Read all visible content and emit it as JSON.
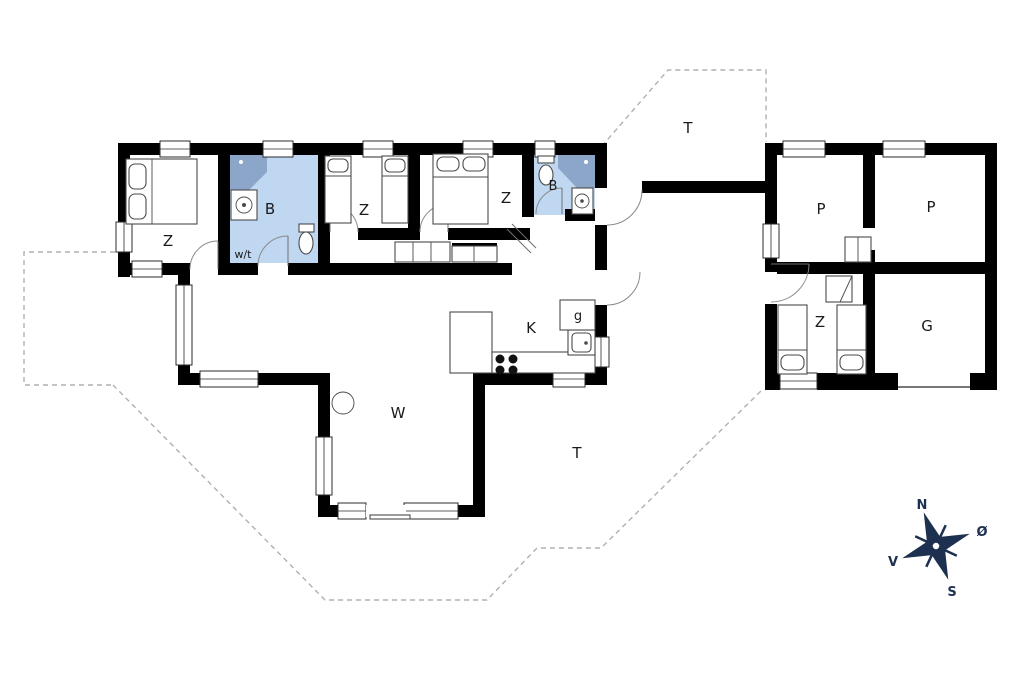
{
  "plan": {
    "type": "floor-plan",
    "colors": {
      "bath": "#bfd7f1",
      "shower": "#8ba6c9",
      "wall": "#000000",
      "dash": "#b0b0b0",
      "compass": "#1e3050"
    },
    "labels": {
      "bedroom1": "Z",
      "bath1": "B",
      "washtech": "w/t",
      "bedroom2": "Z",
      "bedroom3": "Z",
      "bath2": "B",
      "kitchen": "K",
      "pantry": "g",
      "living": "W",
      "terrace_top": "T",
      "terrace_bottom": "T",
      "annex_room1": "P",
      "annex_room2": "P",
      "annex_bedroom": "Z",
      "garage": "G"
    },
    "compass": {
      "north": "N",
      "east": "Ø",
      "south": "S",
      "west": "V"
    }
  }
}
